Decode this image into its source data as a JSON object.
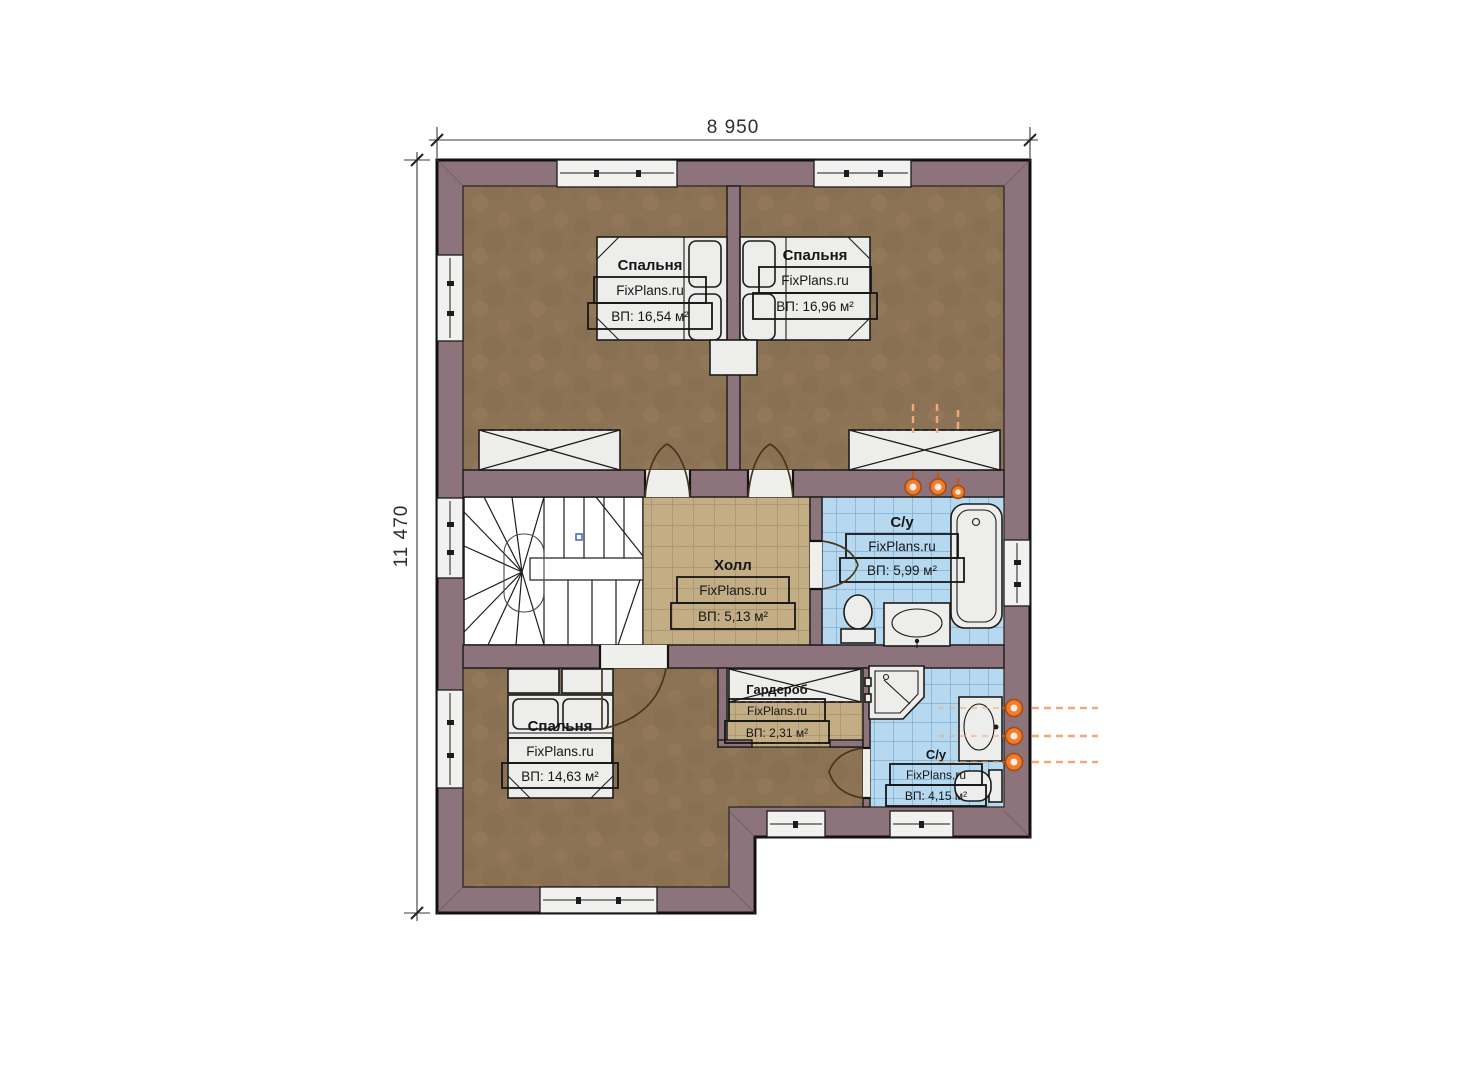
{
  "dimensions": {
    "width": "8 950",
    "height": "11 470"
  },
  "watermark": "FixPlans.ru",
  "rooms": {
    "bedroom_top_left": {
      "name": "Спальня",
      "area": "ВП: 16,54 м²"
    },
    "bedroom_top_right": {
      "name": "Спальня",
      "area": "ВП: 16,96 м²"
    },
    "hall": {
      "name": "Холл",
      "area": "ВП: 5,13 м²"
    },
    "bathroom_middle": {
      "name": "С/у",
      "area": "ВП: 5,99 м²"
    },
    "bedroom_bottom": {
      "name": "Спальня",
      "area": "ВП: 14,63 м²"
    },
    "wardrobe": {
      "name": "Гардероб",
      "area": "ВП: 2,31 м²"
    },
    "bathroom_bottom": {
      "name": "С/у",
      "area": "ВП: 4,15 м²"
    }
  },
  "colors": {
    "wall": "#8d747c",
    "wood": "#8d7355",
    "tile_hall": "#c3ad85",
    "tile_hall_line": "#a18c65",
    "tile_bath": "#b7d9f0",
    "tile_bath_line": "#74a5cc",
    "orange": "#ef7d2c",
    "orange_light": "#f2a878"
  }
}
